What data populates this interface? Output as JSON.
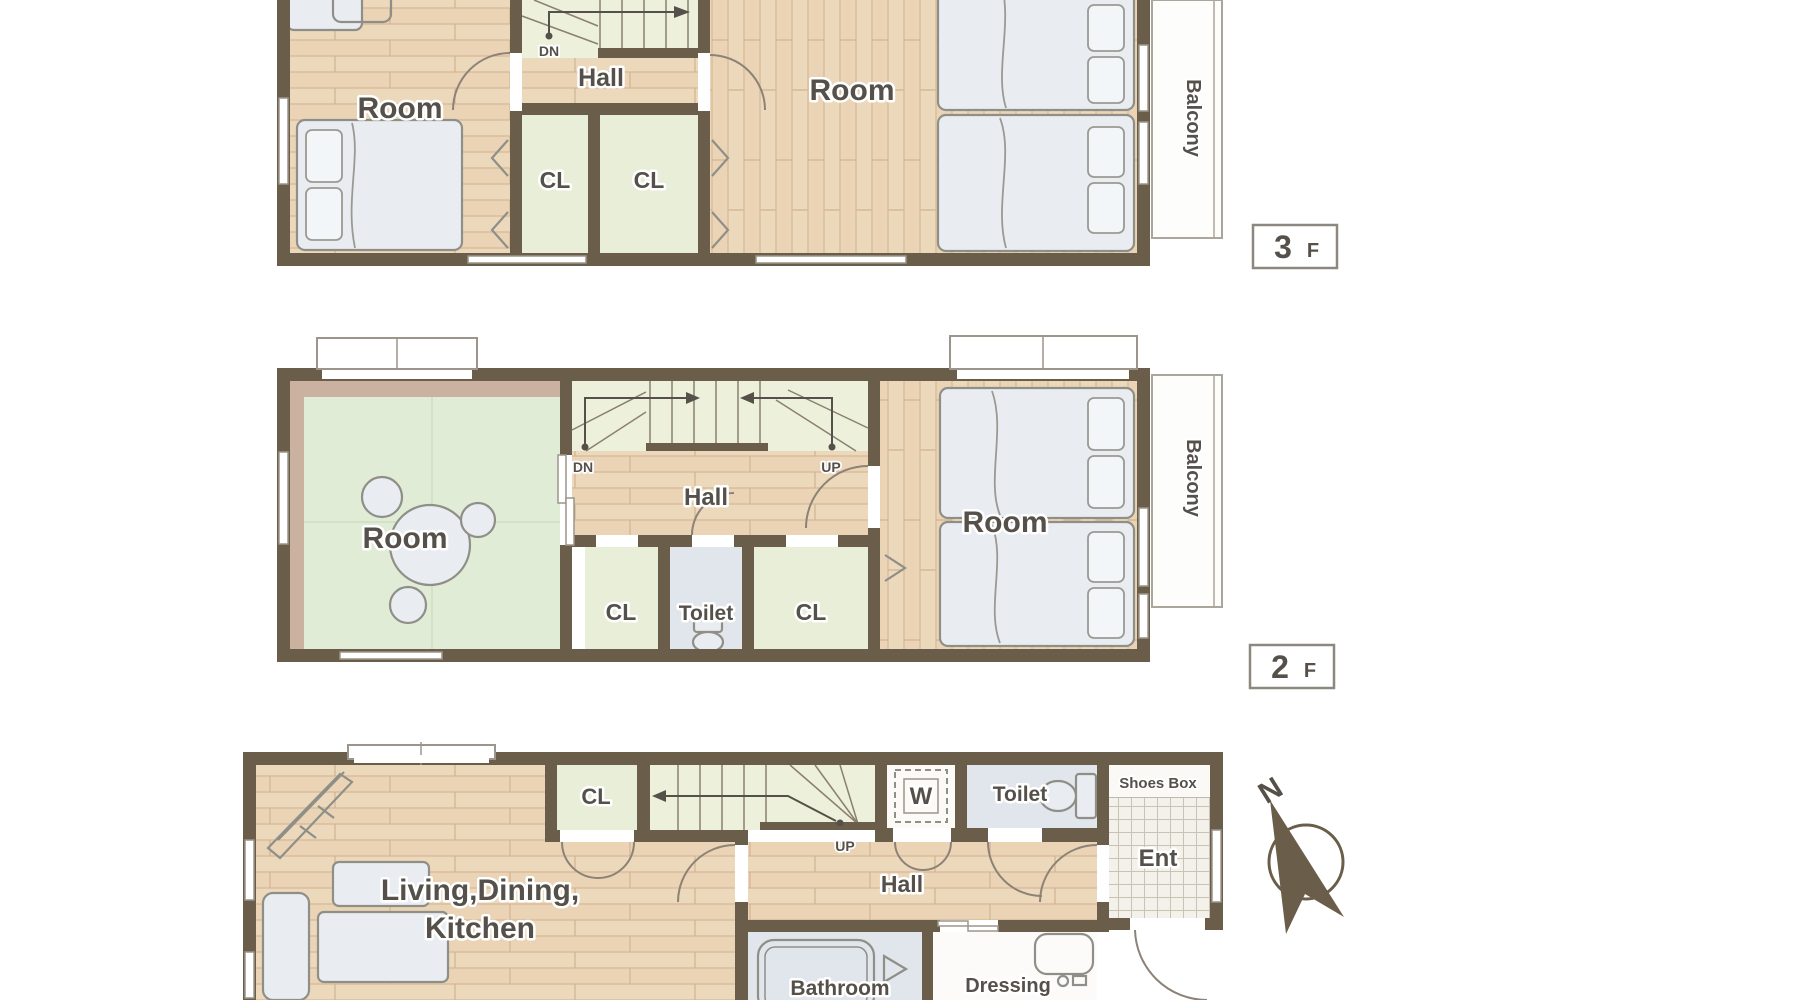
{
  "document": {
    "kind": "house-floor-plan"
  },
  "colors": {
    "wall": "#6a5d49",
    "wood_floor": "#ecd8bb",
    "wood_plank_line": "#d9bd9d",
    "closet_green": "#e9eed8",
    "stairs_green": "#edf0da",
    "tatami_green": "#e1ecd7",
    "tatami_edge": "#cbb1a0",
    "fixture_fill": "#e9edf2",
    "fixture_stroke": "#8f8f88",
    "wet_room_blue": "#e0e6eb",
    "entrance_tile": "#f3f1ea",
    "label_text": "#55504a",
    "balcony_line": "#aba69b"
  },
  "floor3": {
    "badge": {
      "number": "3",
      "suffix": "F"
    },
    "labels": {
      "room_left": "Room",
      "hall": "Hall",
      "stair_down": "DN",
      "closet1": "CL",
      "closet2": "CL",
      "room_right": "Room",
      "balcony": "Balcony"
    }
  },
  "floor2": {
    "badge": {
      "number": "2",
      "suffix": "F"
    },
    "labels": {
      "room_left": "Room",
      "hall": "Hall",
      "stair_down": "DN",
      "stair_up": "UP",
      "closet1": "CL",
      "toilet": "Toilet",
      "closet2": "CL",
      "room_right": "Room",
      "balcony": "Balcony"
    }
  },
  "floor1": {
    "labels": {
      "ldk_line1": "Living,Dining,",
      "ldk_line2": "Kitchen",
      "closet": "CL",
      "stair_up": "UP",
      "washer": "W",
      "toilet": "Toilet",
      "shoes_box": "Shoes Box",
      "entrance": "Ent",
      "hall": "Hall",
      "bathroom": "Bathroom",
      "dressing_line1": "Dressing",
      "dressing_line2": "Room"
    }
  },
  "compass": {
    "north": "N"
  }
}
